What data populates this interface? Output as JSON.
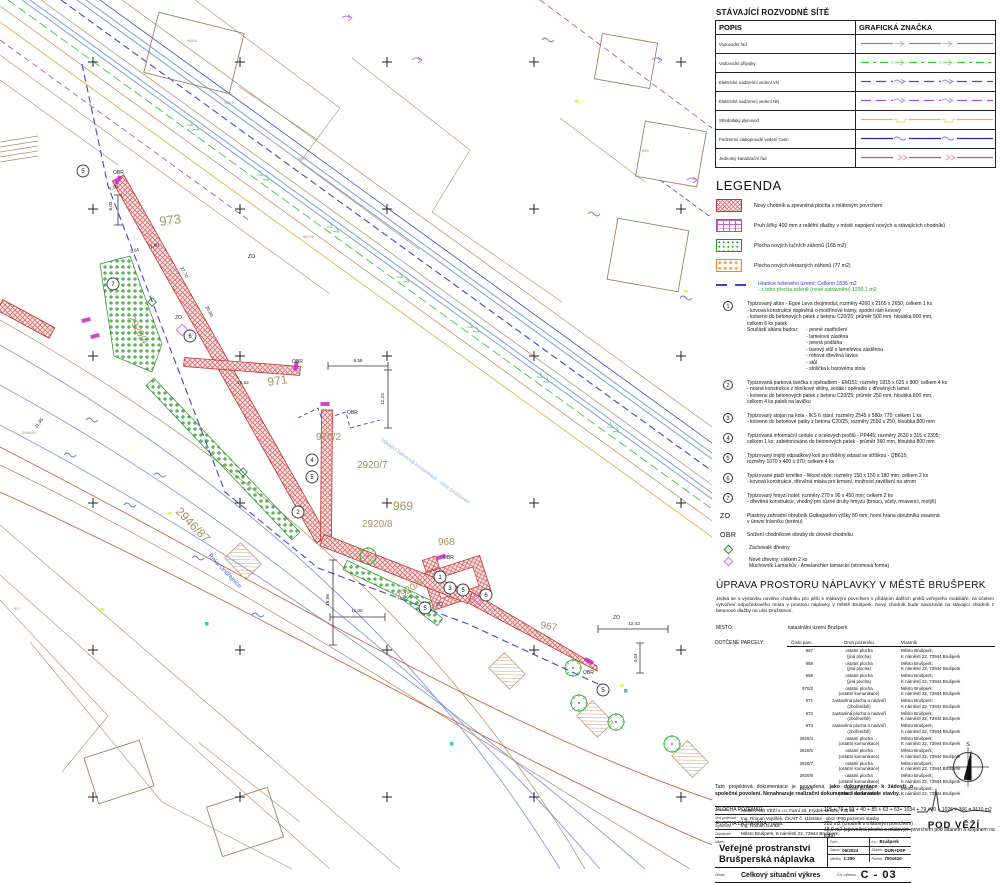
{
  "panel": {
    "north_label": "S",
    "networks": {
      "title": "STÁVAJÍCÍ ROZVODNÉ SÍTĚ",
      "col1": "POPIS",
      "col2": "GRAFICKÁ ZNAČKA",
      "rows": [
        {
          "label": "Vodovodní řad",
          "color": "#2ecc2e",
          "dash": "",
          "symbol": "arrow"
        },
        {
          "label": "Vodovodní přípojky",
          "color": "#2ecc2e",
          "dash": "8 4 3 4",
          "symbol": "arrow"
        },
        {
          "label": "Elektrické nadzemní vedení VN",
          "color": "#7d2fc2",
          "dash": "10 5",
          "symbol": "warr"
        },
        {
          "label": "Elektrické nadzemní vedení NN",
          "color": "#a24fd6",
          "dash": "10 5",
          "symbol": "warr"
        },
        {
          "label": "Středotlaký plynovod",
          "color": "#e8b832",
          "dash": "",
          "symbol": "bump"
        },
        {
          "label": "Podzemní slaboproudé vedení Cetin",
          "color": "#2424c8",
          "dash": "",
          "symbol": "wave"
        },
        {
          "label": "Jednotný kanalizační řad",
          "color": "#cd5c3a",
          "dash": "",
          "symbol": "chev"
        }
      ]
    },
    "legend": {
      "title": "LEGENDA",
      "items": [
        {
          "swatch": "sw-red",
          "text": "Nový chodník a zpevněná plocha s mlátovým povrchem"
        },
        {
          "swatch": "sw-purple",
          "text": "Pruh šířky 400 mm z reliéfní dlažby v místě napojení nových a stávajících chodníků"
        },
        {
          "swatch": "sw-green",
          "text": "Plocha nových lučních záhonů (165 m2)"
        },
        {
          "swatch": "sw-orange",
          "text": "Plocha nových okrasných záhonů (77 m2)"
        }
      ],
      "boundary_line1": "Hranice řešeného území; Celkem 1836 m2",
      "boundary_line2": "- z toho plocha zeleně (nové zatravnění) 1290,1 m2"
    },
    "numbered_items": [
      {
        "num": "1",
        "lines": [
          "Typizovaný altán - Egoe Leva dvojmodul; rozměry 4260 x 2165 x 2650; celkem 1 ks",
          "- kovová konstrukce doplněná o modřínové trámy, spodní rám kovový",
          "- kotveno do betonových patek z betonu C20/25; průměr 500 mm, hloubka 800 mm,",
          "celkem 6 ks patek"
        ],
        "sublist_label": "Součástí altánu budou:",
        "sublist": [
          "- pevné zastřešení",
          "- lamelová zástěna",
          "- pevná podlaha",
          "- barový stůl s lamelovou zástěnou",
          "- rohová dřevěná lavice",
          "- stůl",
          "- stolička k barovému stolu"
        ]
      },
      {
        "num": "2",
        "lines": [
          "Typizovaná parková lavička s opěradlem - EM151; rozměry 1815 x 625 x 800; celkem 4 ks",
          "- nosná konstrukce z hliníkové slitiny, sedák i opěradlo z dřevěných lamel",
          "- kotveno do betonových patek z betonu C20/25; průměr 250 mm, hloubka 800 mm,",
          "celkem 4 ks patek na lavičku"
        ]
      },
      {
        "num": "3",
        "lines": [
          "Typizovaný stojan na kola - IKS 6 stání; rozměry 2545 x 580x 770; celkem 1 ks",
          "- kotveno do betonové patky z betonu C20/25; rozměry 2550 x 250, hloubka 800 mm"
        ]
      },
      {
        "num": "4",
        "lines": [
          "Typizovaná informační cedule z ocelových profilů - PP445; rozměry 2630 x 315 x 2305;",
          "celkem 1 ks; zabetonováno do betonových patek - průměr 360 mm, hloubka 800 mm"
        ]
      },
      {
        "num": "5",
        "lines": [
          "Typizovaný trojitý odpadkový koš pro tříděný odpad se stříškou - QB615;",
          "rozměry 1070 x 400 x 970; celkem 4 ks"
        ]
      },
      {
        "num": "6",
        "lines": [
          "Typizované ptačí krmítko - Wood style; rozměry 150 x 150 x 180 mm; celkem 2 ks",
          "- kovová konstrukce, dřevěná miska pro krmení, možnost zavěšení na strom"
        ]
      },
      {
        "num": "7",
        "lines": [
          "Typizovaný hmyzí hotel; rozměry 270 x 90 x 450 mm; celkem 2 ks",
          "- dřevěná konstrukce, vhodný pro různé druhy hmyzu (brouci, včely, mravenci, motýli)"
        ]
      }
    ],
    "zo": {
      "code": "ZO",
      "line1": "Plastový zahradní obrubník Guttagarden výšky 80 mm; horní hrana obrubníku osazená",
      "line2": "v úrovni trávníku (terénu)"
    },
    "obr": {
      "code": "OBR",
      "text": "Snížení chodníkové obruby do úrovně chodníku"
    },
    "trees_kept": "Zachovalé dřeviny",
    "trees_new1": "Nové dřeviny; celkem 2 ks",
    "trees_new2": "Muchovník Lamarkův - Amelanchier lamarckii (stromová forma)",
    "upr_title": "ÚPRAVA PROSTORU NÁPLAVKY V MĚSTĚ BRUŠPERK",
    "description": "Jedná se o výstavbu nového chodníku pro pěší s mlátovým povrchem s přidáním dalších prvků veřejného mobiliáře, za účelem vytvoření odpočinkového místa v prostoru náplavky v městě Brušperk. Nový chodník bude navazovat na stávající chodník z betonové dlažby na ulici Družstevní.",
    "misto_label": "MÍSTO:",
    "misto_value": "katastrální území Brušperk",
    "parcels": {
      "label": "DOTČENÉ PARCELY:",
      "col1": "Číslo parc.",
      "col2": "Druh pozemku",
      "col3": "Vlastník",
      "rows": [
        {
          "num": "967",
          "type1": "ostatní plocha",
          "type2": "(jiná plocha)",
          "owner1": "Město Brušperk;",
          "owner2": "K náměstí 22, 73944 Brušperk"
        },
        {
          "num": "968",
          "type1": "ostatní plocha",
          "type2": "(jiná plocha)",
          "owner1": "Město Brušperk;",
          "owner2": "K náměstí 22, 73944 Brušperk"
        },
        {
          "num": "969",
          "type1": "ostatní plocha",
          "type2": "(jiná plocha)",
          "owner1": "Město Brušperk;",
          "owner2": "K náměstí 22, 73944 Brušperk"
        },
        {
          "num": "970/2",
          "type1": "ostatní plocha",
          "type2": "(ostatní komunikace)",
          "owner1": "Město Brušperk;",
          "owner2": "K náměstí 22, 73944 Brušperk"
        },
        {
          "num": "971",
          "type1": "zastavěná plocha a nádvoří",
          "type2": "(zbořeniště)",
          "owner1": "Město Brušperk;",
          "owner2": "K náměstí 22, 73944 Brušperk"
        },
        {
          "num": "972",
          "type1": "zastavěná plocha a nádvoří",
          "type2": "(zbořeniště)",
          "owner1": "Město Brušperk;",
          "owner2": "K náměstí 22, 73944 Brušperk"
        },
        {
          "num": "973",
          "type1": "zastavěná plocha a nádvoří",
          "type2": "(zbořeniště)",
          "owner1": "Město Brušperk;",
          "owner2": "K náměstí 22, 73944 Brušperk"
        },
        {
          "num": "2920/4",
          "type1": "ostatní plocha",
          "type2": "(ostatní komunikace)",
          "owner1": "Město Brušperk;",
          "owner2": "K náměstí 22, 73944 Brušperk"
        },
        {
          "num": "2920/5",
          "type1": "ostatní plocha",
          "type2": "(ostatní komunikace)",
          "owner1": "Město Brušperk;",
          "owner2": "K náměstí 22, 73944 Brušperk"
        },
        {
          "num": "2920/7",
          "type1": "ostatní plocha",
          "type2": "(ostatní komunikace)",
          "owner1": "Město Brušperk;",
          "owner2": "K náměstí 22, 73944 Brušperk"
        },
        {
          "num": "2920/8",
          "type1": "ostatní plocha",
          "type2": "(ostatní komunikace)",
          "owner1": "Město Brušperk;",
          "owner2": "K náměstí 22, 73944 Brušperk"
        },
        {
          "num": "2920/9",
          "type1": "ostatní plocha",
          "type2": "(ostatní komunikace)",
          "owner1": "Město Brušperk;",
          "owner2": "K náměstí 22, 73944 Brušperk"
        }
      ]
    },
    "area_label": "PLOCHA POZEMKŮ:",
    "area_value": "115 + 76 + 93 + 40 + 85 + 63 + 63+ 1034 + 79 +70 + 1026 + 366 = 3110 m2",
    "built_label": "PLOCHA ZASTAVĚNÁ - nová:",
    "built_line1": "285 m2 (chodník s mlátovým povrchem)",
    "built_line2": "18,9 m2 (zpevněná plocha s mlátovým povrchem pod altánem a stojanem na kola)",
    "note_normal": "Tato projektová dokumentace je provedená, ",
    "note_bold": "jako dokumentace k žádosti o společné povolení. Nenahrazuje realizační dokumentaci dodavatele stavby.",
    "titleblock": {
      "rows": [
        {
          "label": "Zhotovitel:",
          "value": "Ateliér POD VĚŽÍ s.r.o, Farní 20, Frýdek-Místek, 738 01"
        },
        {
          "label": "Ved. projektant:",
          "value": "Ing. Roman Vojtíšek, ČKAIT č. 1104364 - obor IP00 pozemní stavby"
        },
        {
          "label": "Vypracoval:",
          "value": "Ing. Roman Guňka"
        },
        {
          "label": "Objednatel:",
          "value": "Město Brušperk, K náměstí 22, 73944 Brušperk"
        }
      ],
      "nazev_label": "Název:",
      "nazev_line1": "Veřejné prostranství",
      "nazev_line2": "Brušperská náplavka",
      "fields": [
        {
          "label": "Paré:",
          "value": ""
        },
        {
          "label": "k.ú.:",
          "value": "Brušperk"
        },
        {
          "label": "Datum:",
          "value": "05/2024"
        },
        {
          "label": "Stupeň:",
          "value": "DUR+DSP"
        },
        {
          "label": "Měřítko:",
          "value": "1:250"
        },
        {
          "label": "Formát:",
          "value": "700x610"
        }
      ],
      "obsah_label": "Obsah:",
      "obsah_value": "Celkový situační výkres",
      "cislo_label": "Čís. výkresu:",
      "cislo_value": "C - 03",
      "logo_text": "POD VĚŽÍ"
    }
  },
  "map": {
    "labels": [
      {
        "t": "973",
        "x": 160,
        "y": 226,
        "s": 13,
        "c": "br",
        "r": -8
      },
      {
        "t": "971",
        "x": 268,
        "y": 386,
        "s": 12,
        "c": "br",
        "r": -8
      },
      {
        "t": "970/2",
        "x": 316,
        "y": 440,
        "s": 10,
        "c": "br",
        "r": 0
      },
      {
        "t": "2920/7",
        "x": 357,
        "y": 468,
        "s": 10,
        "c": "br",
        "r": 0
      },
      {
        "t": "969",
        "x": 393,
        "y": 510,
        "s": 12,
        "c": "br",
        "r": 0
      },
      {
        "t": "2920/8",
        "x": 362,
        "y": 527,
        "s": 10,
        "c": "br",
        "r": 0
      },
      {
        "t": "968",
        "x": 438,
        "y": 545,
        "s": 10,
        "c": "br",
        "r": 0
      },
      {
        "t": "2920/9",
        "x": 398,
        "y": 600,
        "s": 10,
        "c": "br",
        "r": -32
      },
      {
        "t": "967",
        "x": 540,
        "y": 628,
        "s": 10,
        "c": "br",
        "r": 10
      },
      {
        "t": "2946/87",
        "x": 175,
        "y": 512,
        "s": 12,
        "c": "br",
        "r": 46
      },
      {
        "t": "2920/4",
        "x": 128,
        "y": 318,
        "s": 10,
        "c": "br",
        "r": 61
      },
      {
        "t": "985/4",
        "x": 187,
        "y": 42,
        "s": 4,
        "c": "br",
        "r": 0
      },
      {
        "t": "985/3",
        "x": 224,
        "y": 104,
        "s": 4,
        "c": "br",
        "r": 0
      },
      {
        "t": "987/2",
        "x": 298,
        "y": 160,
        "s": 4,
        "c": "br",
        "r": 0
      },
      {
        "t": "987/4",
        "x": 303,
        "y": 238,
        "s": 4,
        "c": "br",
        "r": 0
      },
      {
        "t": "965",
        "x": 642,
        "y": 152,
        "s": 4,
        "c": "br",
        "r": 0
      },
      {
        "t": "927",
        "x": 14,
        "y": 610,
        "s": 4,
        "c": "br",
        "r": 0
      },
      {
        "t": "2946/90",
        "x": 22,
        "y": 434,
        "s": 4,
        "c": "br",
        "r": 0
      },
      {
        "t": "Řeka Ondřejnice",
        "x": 208,
        "y": 556,
        "s": 6,
        "c": "bl",
        "r": 46
      },
      {
        "t": "Stávající betonová komunikace - ulice Družstevní",
        "x": 380,
        "y": 440,
        "s": 5,
        "c": "lb",
        "r": 36
      },
      {
        "t": "ZO",
        "x": 248,
        "y": 258,
        "s": 5,
        "c": "bk",
        "r": 0
      },
      {
        "t": "ZO",
        "x": 175,
        "y": 319,
        "s": 5,
        "c": "bk",
        "r": 0
      },
      {
        "t": "ZO",
        "x": 436,
        "y": 606,
        "s": 5,
        "c": "bk",
        "r": 0
      },
      {
        "t": "ZO",
        "x": 613,
        "y": 619,
        "s": 5,
        "c": "bk",
        "r": 0
      },
      {
        "t": "OBR",
        "x": 113,
        "y": 174,
        "s": 5,
        "c": "bk",
        "r": 0
      },
      {
        "t": "OBR",
        "x": 292,
        "y": 363,
        "s": 5,
        "c": "bk",
        "r": 0
      },
      {
        "t": "OBR",
        "x": 347,
        "y": 414,
        "s": 5,
        "c": "bk",
        "r": 0
      },
      {
        "t": "OBR",
        "x": 443,
        "y": 559,
        "s": 5,
        "c": "bk",
        "r": 0
      },
      {
        "t": "OBR",
        "x": 583,
        "y": 674,
        "s": 5,
        "c": "bk",
        "r": 0
      }
    ],
    "dimensions": [
      {
        "t": "9,59",
        "x": 358,
        "y": 362,
        "r": 0
      },
      {
        "t": "12,24",
        "x": 384,
        "y": 399,
        "r": -90
      },
      {
        "t": "19,52",
        "x": 243,
        "y": 384,
        "r": 0
      },
      {
        "t": "11,00",
        "x": 357,
        "y": 612,
        "r": 0
      },
      {
        "t": "16,56",
        "x": 329,
        "y": 600,
        "r": -90
      },
      {
        "t": "12,43",
        "x": 634,
        "y": 625,
        "r": 0
      },
      {
        "t": "4,04",
        "x": 637,
        "y": 658,
        "r": -90
      },
      {
        "t": "11,95",
        "x": 40,
        "y": 424,
        "r": -52
      },
      {
        "t": "3,54",
        "x": 135,
        "y": 252,
        "r": -15
      },
      {
        "t": "1,80",
        "x": 155,
        "y": 247,
        "r": -15
      },
      {
        "t": "1,50",
        "x": 114,
        "y": 189,
        "r": -15
      },
      {
        "t": "6,03",
        "x": 112,
        "y": 206,
        "r": -90
      },
      {
        "t": "20,00",
        "x": 208,
        "y": 312,
        "r": 62
      },
      {
        "t": "27,70",
        "x": 183,
        "y": 273,
        "r": 62
      }
    ],
    "markers": [
      {
        "n": "5",
        "x": 83,
        "y": 171
      },
      {
        "n": "7",
        "x": 113,
        "y": 284
      },
      {
        "n": "2",
        "x": 298,
        "y": 512
      },
      {
        "n": "4",
        "x": 312,
        "y": 460
      },
      {
        "n": "5",
        "x": 312,
        "y": 477
      },
      {
        "n": "6",
        "x": 190,
        "y": 336
      },
      {
        "n": "1",
        "x": 440,
        "y": 577
      },
      {
        "n": "3",
        "x": 450,
        "y": 588
      },
      {
        "n": "5",
        "x": 463,
        "y": 590
      },
      {
        "n": "6",
        "x": 486,
        "y": 595
      },
      {
        "n": "5",
        "x": 425,
        "y": 608
      },
      {
        "n": "5",
        "x": 603,
        "y": 690
      }
    ],
    "colors": {
      "br": "#a98e5f",
      "bl": "#3355cc",
      "lb": "#85aede",
      "bk": "#222222"
    }
  }
}
